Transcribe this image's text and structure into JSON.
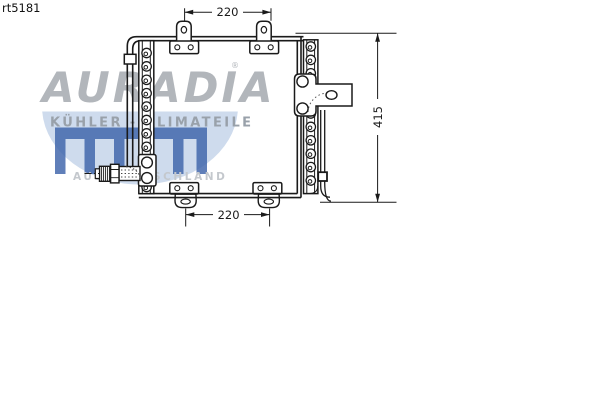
{
  "page": {
    "part_number": "rt5181"
  },
  "watermark": {
    "brand": "AURADIA",
    "registered": "®",
    "tagline": "KÜHLER - KLIMATEILE",
    "origin": "AUS DEUTSCHLAND",
    "colors": {
      "brand": "#b2b6bb",
      "tagline": "#99a1aa",
      "origin": "#c4c8cd",
      "comb": "#3e64aa",
      "disc": "#c9d7eb"
    }
  },
  "diagram": {
    "line_color": "#1a1a1a",
    "dimensions": {
      "top_width": "220",
      "bottom_width": "220",
      "height": "415"
    }
  }
}
